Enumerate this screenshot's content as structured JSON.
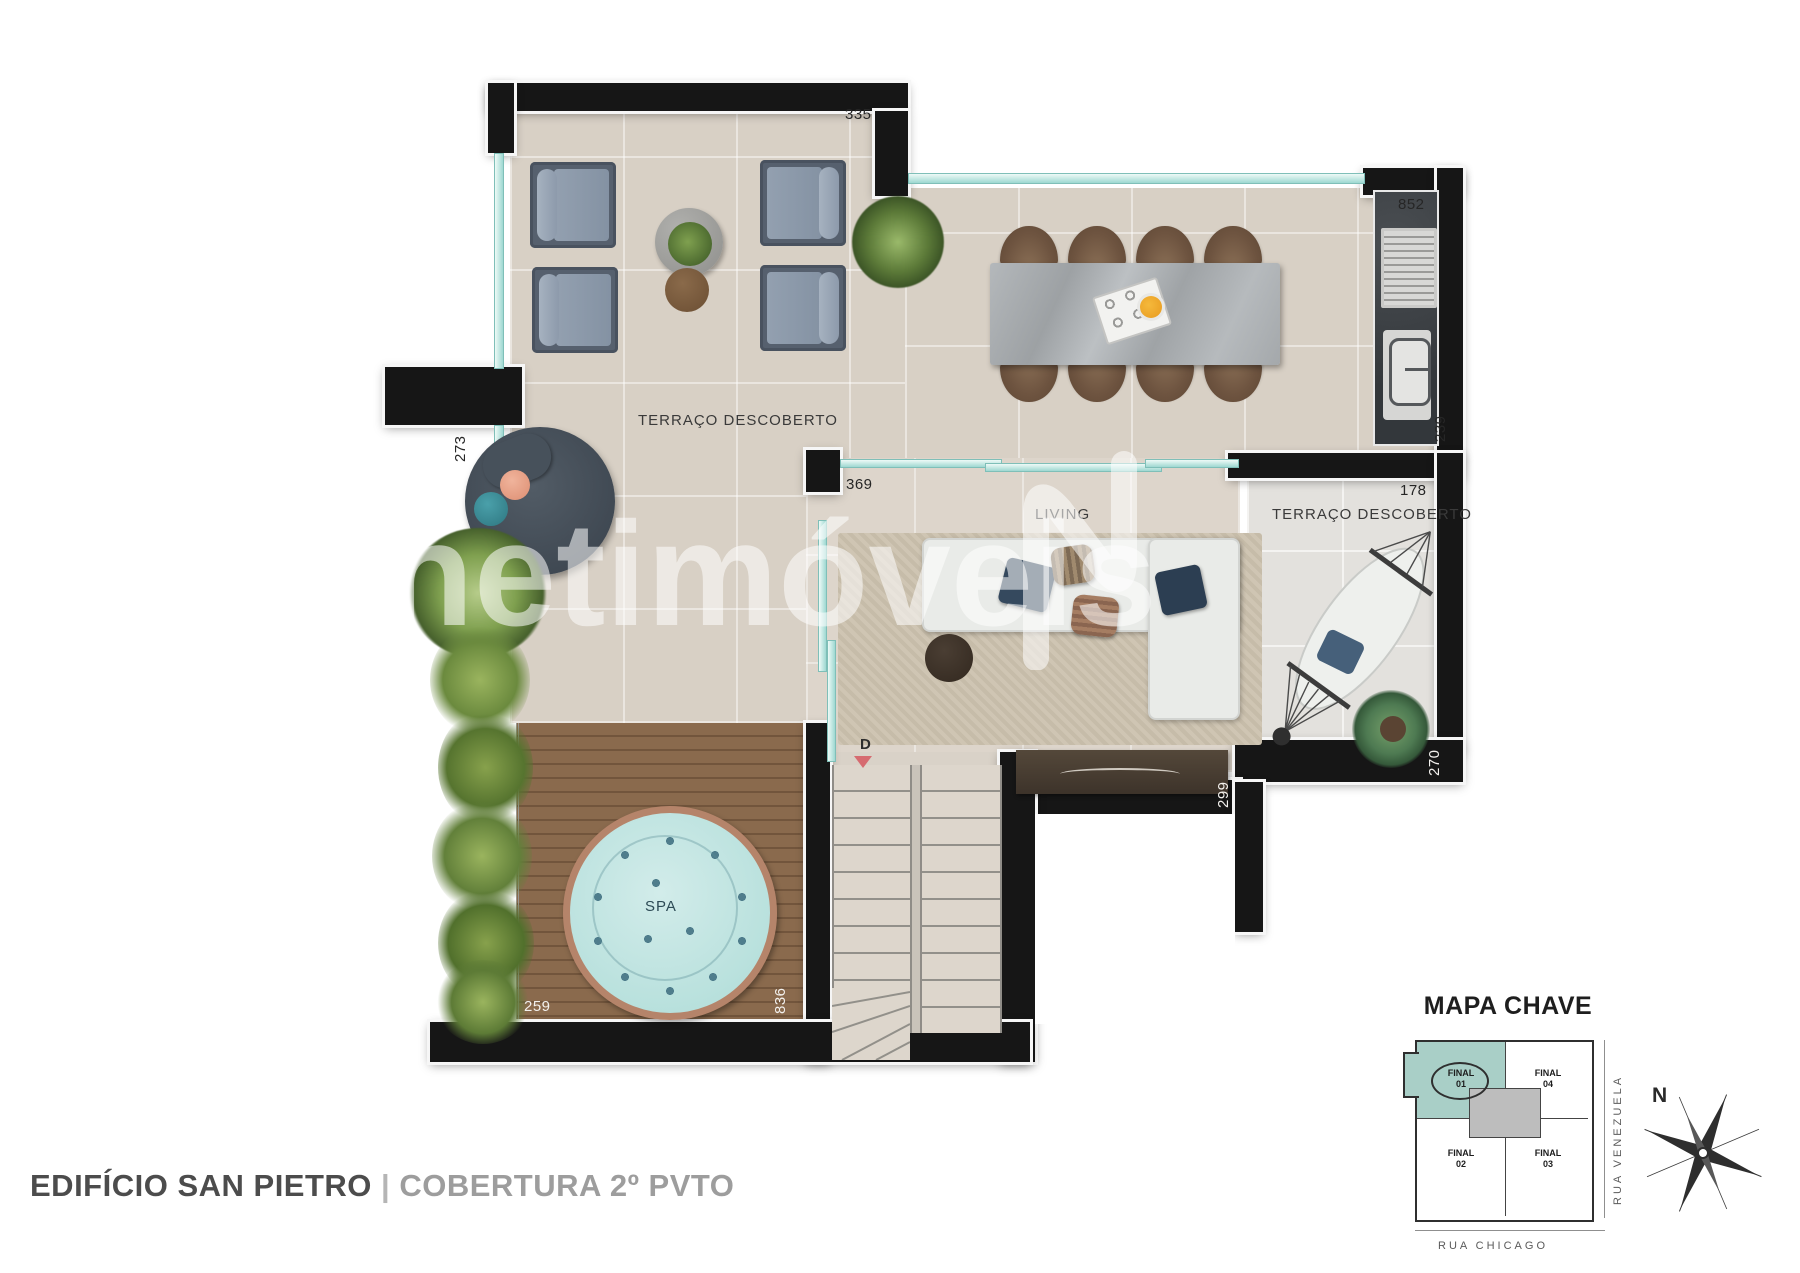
{
  "watermark": {
    "text": "netimóveis",
    "logo": "netimoveis-n-logo"
  },
  "rooms": {
    "terrace_top": "TERRAÇO DESCOBERTO",
    "living": "LIVING",
    "terrace_right": "TERRAÇO DESCOBERTO",
    "spa": "SPA"
  },
  "dimensions": {
    "top_wall": "335",
    "kitchen_top": "852",
    "kitchen_counter": "239",
    "terrace_right_top": "178",
    "left_pillar": "273",
    "living_door": "369",
    "console_wall": "299",
    "terrace_right_bottom": "270",
    "spa_bottom": "259",
    "spa_side": "836"
  },
  "stairs": {
    "marker": "D"
  },
  "footer": {
    "building": "EDIFÍCIO SAN PIETRO",
    "separator": "|",
    "unit": "COBERTURA 2º PVTO"
  },
  "keymap": {
    "title": "MAPA CHAVE",
    "unit_01": {
      "name": "FINAL",
      "number": "01"
    },
    "unit_02": {
      "name": "FINAL",
      "number": "02"
    },
    "unit_03": {
      "name": "FINAL",
      "number": "03"
    },
    "unit_04": {
      "name": "FINAL",
      "number": "04"
    },
    "street_right": "RUA VENEZUELA",
    "street_bottom": "RUA CHICAGO",
    "compass_label": "N"
  },
  "colors": {
    "glass_accent": "#9ed8d1",
    "highlight_unit": "#a9cfc7",
    "down_arrow": "#d66b70",
    "spa_water": "#c3e6e3"
  }
}
